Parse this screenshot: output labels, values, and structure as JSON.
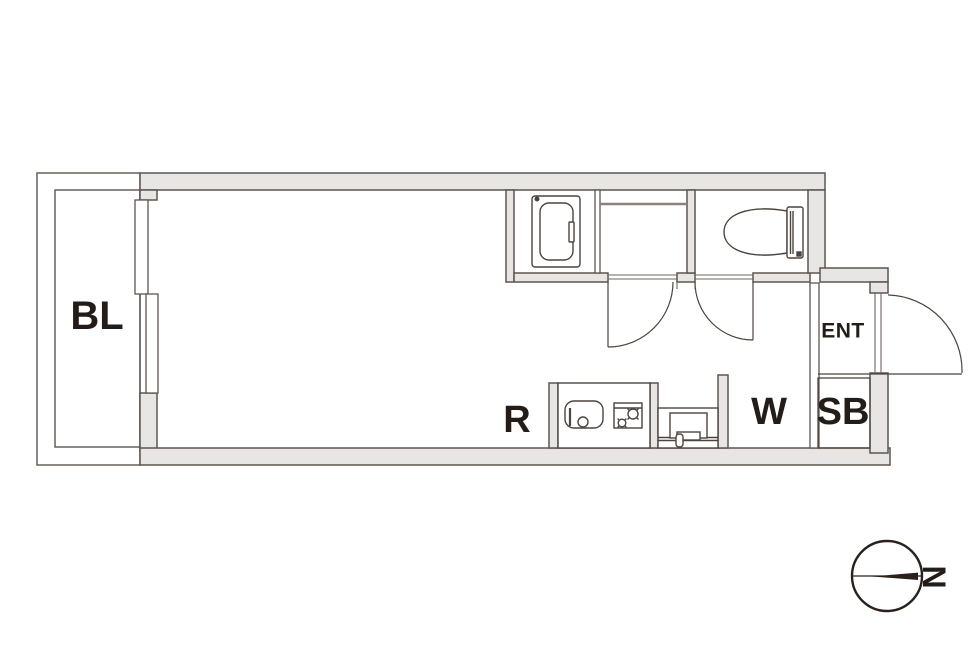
{
  "page": {
    "background": "#ffffff",
    "kind": "apartment floor plan"
  },
  "labels": {
    "balcony": "BL",
    "room": "R",
    "washer_area": "W",
    "shoe_box": "SB",
    "entrance": "ENT"
  },
  "compass": {
    "north_label": "N",
    "needle_direction": "right"
  },
  "colors": {
    "wall_fill": "#e8e6e4",
    "wall_stroke": "#5d5551",
    "fixture_stroke": "#4c443f",
    "line": "#6e6662",
    "counter_line": "#8a8280",
    "text": "#241c17",
    "compass_stroke": "#2a211c"
  },
  "fixtures": [
    "bathtub",
    "vanity-counter",
    "toilet",
    "kitchen-sink",
    "gas-stove",
    "washing-machine",
    "sliding-window",
    "bathroom-door",
    "toilet-door",
    "entrance-door"
  ]
}
